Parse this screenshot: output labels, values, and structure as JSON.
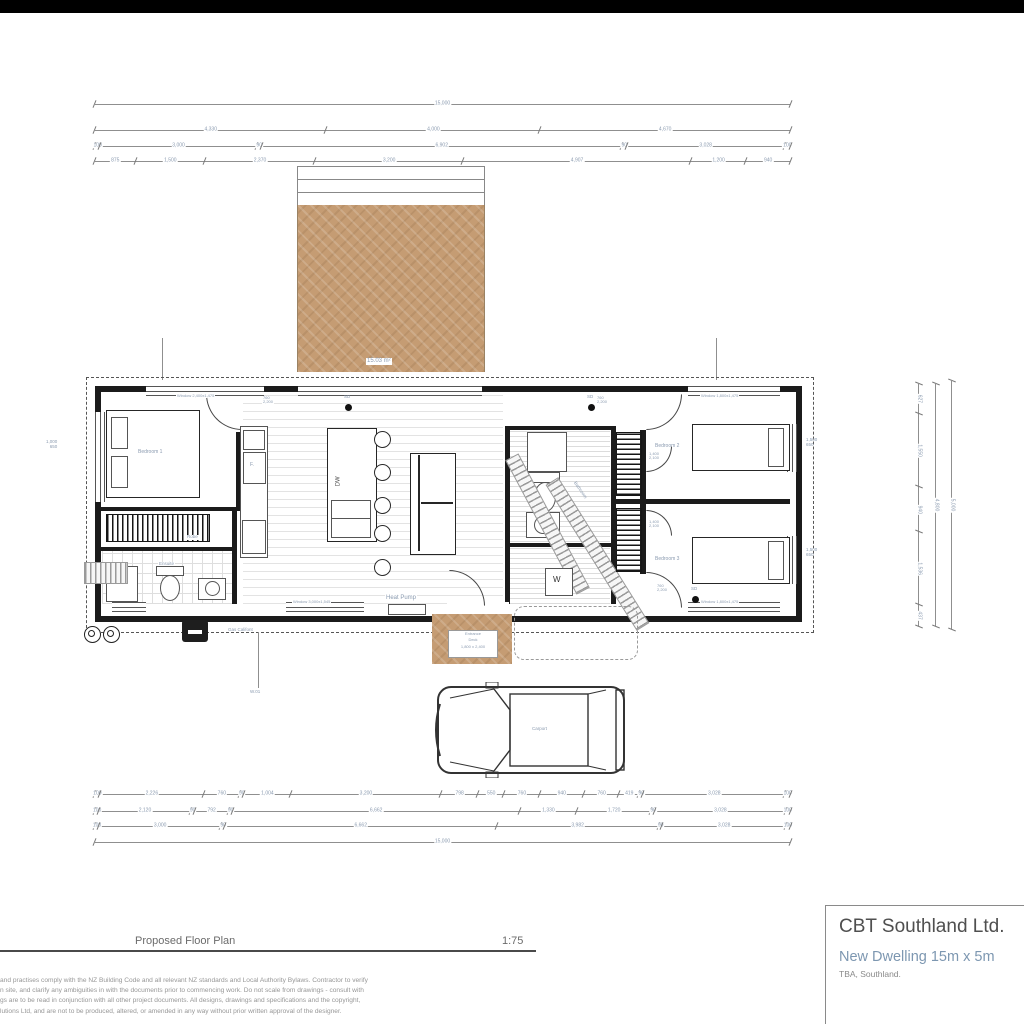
{
  "colors": {
    "deck": "#c59c73",
    "accent": "#7d97b1",
    "dim_text": "#8b9bb0",
    "wall": "#1b1b1b"
  },
  "dims": {
    "top": [
      [
        "15,000"
      ],
      [
        "4,330",
        "4,000",
        "4,670"
      ],
      [
        "100",
        "3,000",
        "90",
        "6,902",
        "90",
        "3,028",
        "100"
      ],
      [
        "875",
        "1,500",
        "2,370",
        "3,200",
        "4,907",
        "1,200",
        "940"
      ]
    ],
    "bottom": [
      [
        "100",
        "2,226",
        "760",
        "90",
        "1,004",
        "3,200",
        "798",
        "550",
        "760",
        "940",
        "760",
        "419",
        "90",
        "3,028",
        "100"
      ],
      [
        "100",
        "2,120",
        "90",
        "792",
        "90",
        "6,662",
        "1,330",
        "1,720",
        "90",
        "3,028",
        "100"
      ],
      [
        "100",
        "3,000",
        "90",
        "6,662",
        "3,982",
        "90",
        "3,028",
        "100"
      ],
      [
        "15,000"
      ]
    ],
    "right": [
      [
        "627",
        "1,550",
        "940",
        "1,536",
        "437"
      ],
      [
        "4,800"
      ],
      [
        "5,000"
      ]
    ]
  },
  "window_tags": {
    "left": {
      "a": "1,000",
      "b": "650"
    },
    "bed2": {
      "a": "1,500",
      "b": "650"
    },
    "bed3": {
      "a": "1,500",
      "b": "650"
    }
  },
  "door_tags": [
    {
      "w": "760",
      "h": "2,200"
    },
    {
      "w": "760",
      "h": "2,200"
    },
    {
      "w": "1,400",
      "h": "2,100"
    },
    {
      "w": "1,400",
      "h": "2,100"
    },
    {
      "w": "760",
      "h": "2,200"
    }
  ],
  "labels": {
    "bedroom1": "Bedroom 1",
    "bedroom2": "Bedroom 2",
    "bedroom3": "Bedroom 3",
    "robe": "Robe",
    "ensuite": "Ensuite",
    "bathroom": "Bathroom",
    "heat_pump": "Heat Pump",
    "gas_califont": "Gas Califont",
    "carport": "Carport",
    "dw": "DW",
    "fridge": "F.",
    "washer": "W",
    "sd": "SD",
    "deck_area": "15.03 m²",
    "win_code": "W.01"
  },
  "windows": {
    "bed1": "Window 2,400x1,475",
    "bed2": "Window 1,800x1,475",
    "bed3": "Window 1,800x1,475",
    "living": "Window 3,000x1,545"
  },
  "entrance": {
    "line1": "Entrance",
    "line2": "Deck",
    "line3": "1,800 x 2,400"
  },
  "footer": {
    "title": "Proposed Floor Plan",
    "scale": "1:75"
  },
  "notes": [
    "and practises comply with the NZ Building Code and all relevant NZ standards and Local Authority Bylaws. Contractor to verify",
    "n site, and clarify any ambiguities in with the documents prior to commencing work. Do not scale from drawings - consult with",
    "gs are to be read in conjunction with all other project documents. All designs, drawings and specifications and the copyright,",
    "lutions Ltd, and are not to be produced, altered, or amended in any way without prior written approval of the designer."
  ],
  "title_block": {
    "company": "CBT Southland Ltd.",
    "project": "New Dwelling 15m x 5m",
    "location": "TBA, Southland."
  }
}
